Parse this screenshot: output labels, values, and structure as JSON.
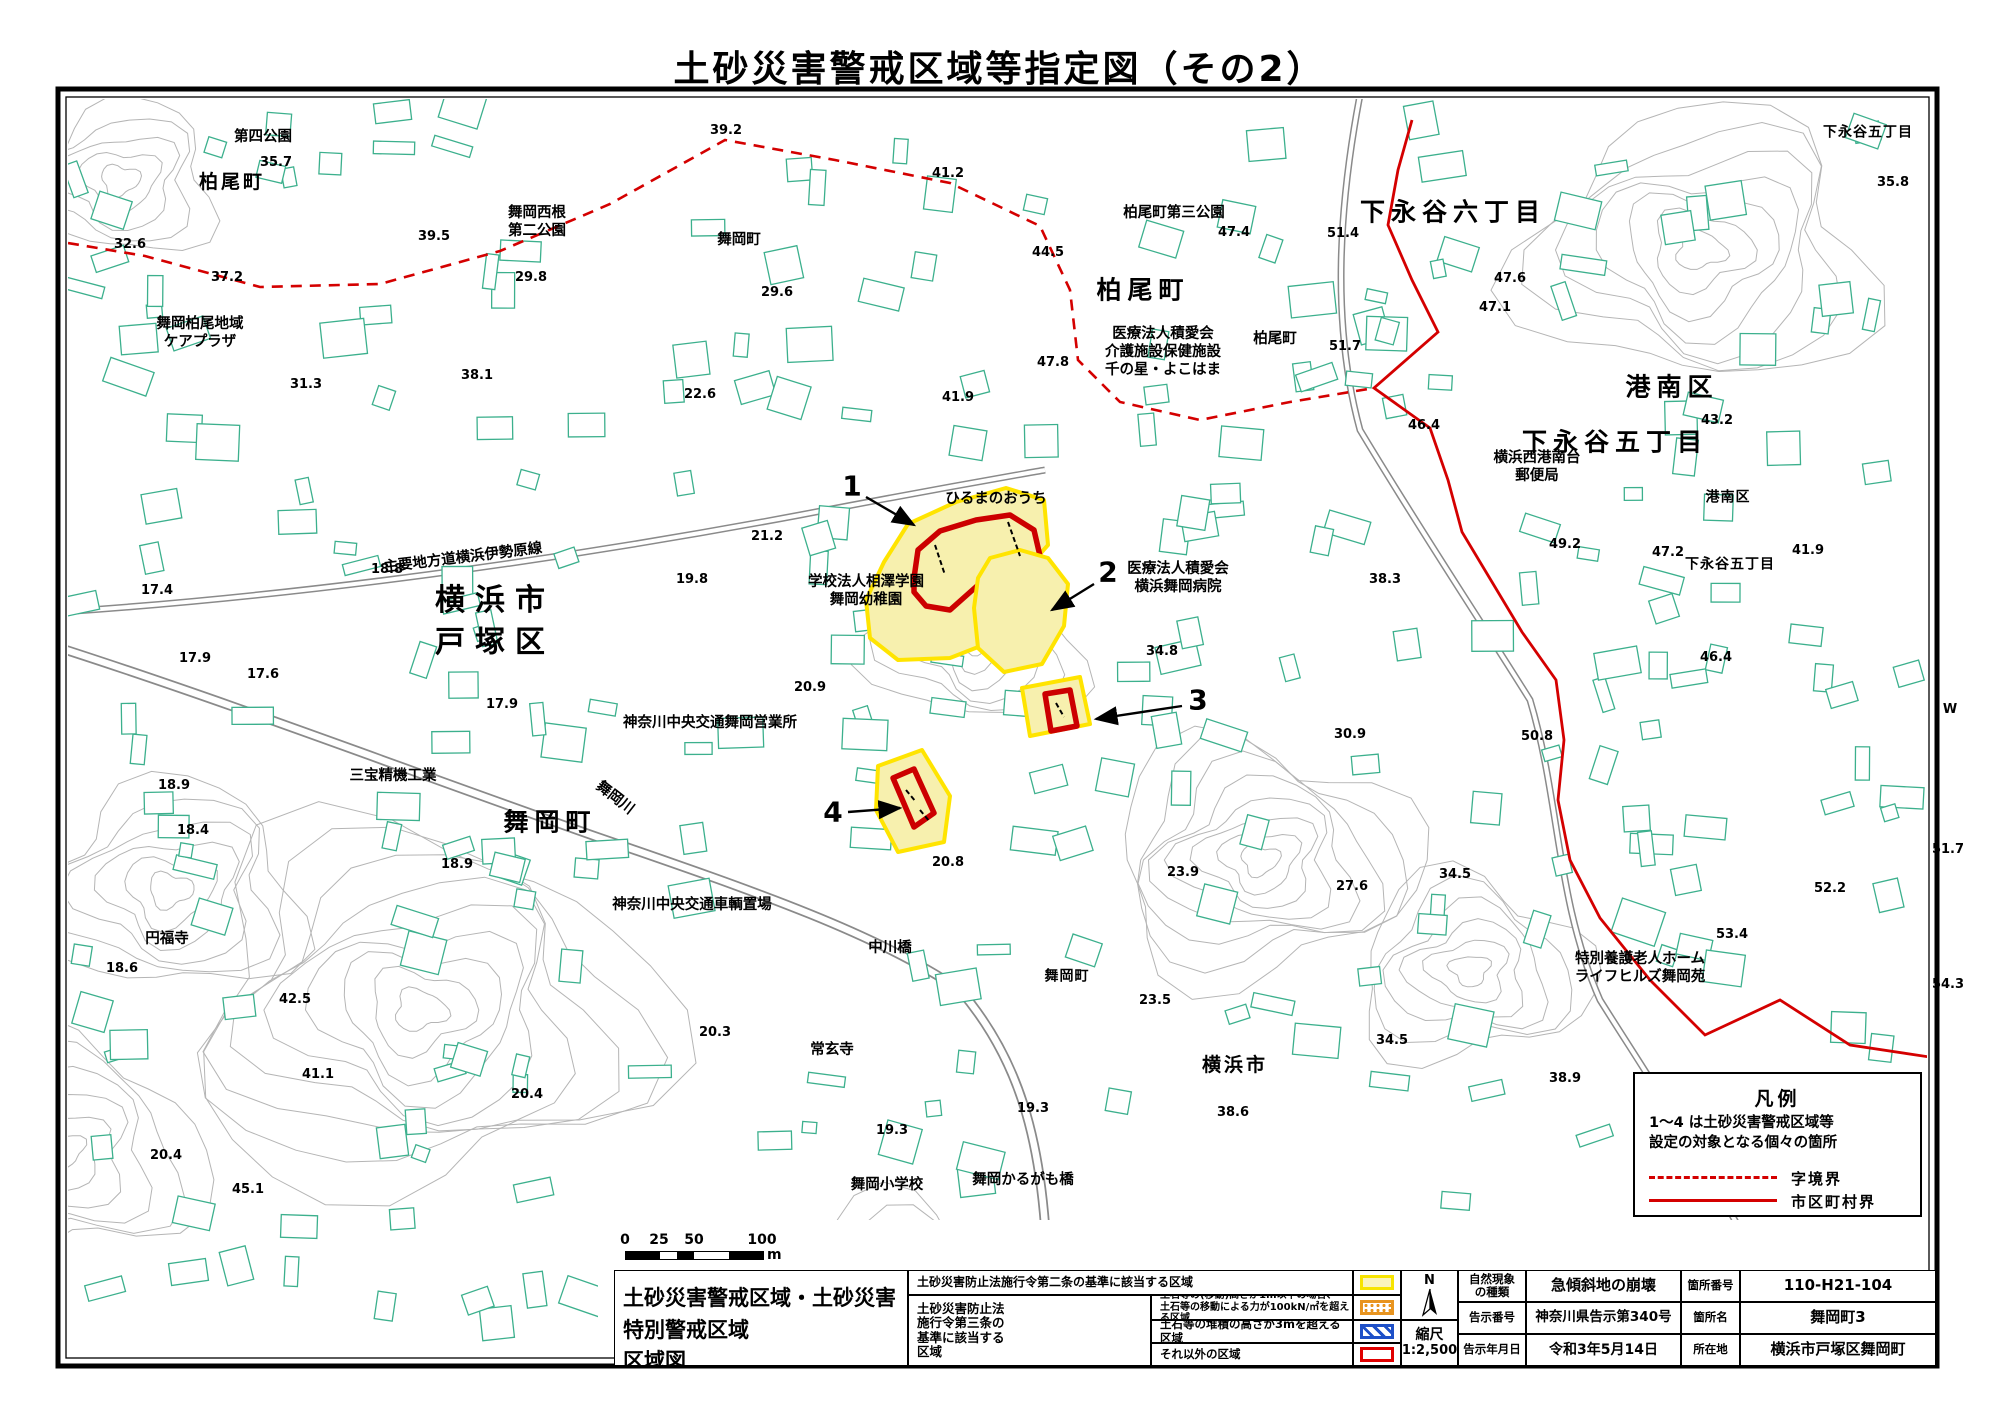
{
  "page_title": "土砂災害警戒区域等指定図（その2）",
  "legend_box": {
    "title": "凡例",
    "note_line1": "1〜4 は土砂災害警戒区域等",
    "note_line2": "設定の対象となる個々の箇所",
    "dashed_label": "字境界",
    "solid_label": "市区町村界",
    "line_color": "#d40000"
  },
  "scale_bar": {
    "ticks": [
      "0",
      "25",
      "50",
      "100"
    ],
    "unit": "m"
  },
  "info_table": {
    "map_title_line1": "土砂災害警戒区域・土砂災害特別警戒区域",
    "map_title_line2": "区域図",
    "law2_label": "土砂災害防止法施行令第二条の基準に該当する区域",
    "law3_group_label": "土砂災害防止法\n施行令第三条の\n基準に該当する\n区域",
    "law3_row1": "土石等の(移動)高さが1m以下の場合、\n土石等の移動による力が100kN/㎡を超える区域",
    "law3_row2": "土石等の堆積の高さが3mを超える区域",
    "law3_row3": "それ以外の区域",
    "north_label": "N",
    "scale_label": "縮尺",
    "scale_value": "1:2,500",
    "nature_label": "自然現象\nの種類",
    "nature_value": "急傾斜地の崩壊",
    "notice_no_label": "告示番号",
    "notice_no_value": "神奈川県告示第340号",
    "notice_date_label": "告示年月日",
    "notice_date_value": "令和3年5月14日",
    "site_no_label": "箇所番号",
    "site_no_value": "110-H21-104",
    "site_name_label": "箇所名",
    "site_name_value": "舞岡町3",
    "location_label": "所在地",
    "location_value": "横浜市戸塚区舞岡町",
    "swatch_colors": {
      "yellow_border": "#f7e400",
      "yellow_fill": "#faf4bc",
      "orange": "#e8941f",
      "blue": "#1e50c8",
      "red": "#e00000"
    }
  },
  "map": {
    "colors": {
      "building": "#3cb08d",
      "contour": "#b5b5b5",
      "road": "#8a8a8a",
      "boundary": "#d40000",
      "zone_fill": "#f7f0ae",
      "zone_border": "#ffe400",
      "zone_red": "#cc0000"
    },
    "boundary_dashed": [
      [
        68,
        243
      ],
      [
        145,
        256
      ],
      [
        260,
        287
      ],
      [
        380,
        284
      ],
      [
        500,
        251
      ],
      [
        610,
        204
      ],
      [
        725,
        140
      ],
      [
        835,
        160
      ],
      [
        950,
        183
      ],
      [
        1040,
        226
      ],
      [
        1070,
        290
      ],
      [
        1078,
        360
      ],
      [
        1120,
        402
      ],
      [
        1200,
        420
      ],
      [
        1290,
        402
      ],
      [
        1374,
        388
      ]
    ],
    "boundary_solid": [
      [
        1412,
        120
      ],
      [
        1398,
        170
      ],
      [
        1388,
        225
      ],
      [
        1412,
        280
      ],
      [
        1438,
        332
      ],
      [
        1374,
        388
      ],
      [
        1430,
        428
      ],
      [
        1448,
        480
      ],
      [
        1462,
        532
      ],
      [
        1492,
        582
      ],
      [
        1522,
        632
      ],
      [
        1556,
        680
      ],
      [
        1564,
        740
      ],
      [
        1558,
        800
      ],
      [
        1570,
        860
      ],
      [
        1600,
        918
      ],
      [
        1650,
        980
      ],
      [
        1705,
        1035
      ],
      [
        1780,
        1000
      ],
      [
        1850,
        1045
      ],
      [
        1936,
        1058
      ]
    ],
    "zones": [
      {
        "id": "1",
        "yellow": [
          [
            884,
            562
          ],
          [
            908,
            524
          ],
          [
            956,
            502
          ],
          [
            1006,
            488
          ],
          [
            1044,
            500
          ],
          [
            1048,
            545
          ],
          [
            1024,
            572
          ],
          [
            1024,
            610
          ],
          [
            996,
            640
          ],
          [
            950,
            658
          ],
          [
            898,
            660
          ],
          [
            870,
            638
          ],
          [
            866,
            600
          ]
        ],
        "red": [
          [
            914,
            578
          ],
          [
            918,
            550
          ],
          [
            940,
            531
          ],
          [
            976,
            520
          ],
          [
            1010,
            515
          ],
          [
            1034,
            530
          ],
          [
            1040,
            556
          ],
          [
            1012,
            570
          ],
          [
            986,
            578
          ],
          [
            968,
            594
          ],
          [
            950,
            610
          ],
          [
            926,
            606
          ],
          [
            914,
            592
          ]
        ]
      },
      {
        "id": "2",
        "yellow": [
          [
            990,
            558
          ],
          [
            1020,
            550
          ],
          [
            1048,
            558
          ],
          [
            1068,
            584
          ],
          [
            1064,
            626
          ],
          [
            1042,
            664
          ],
          [
            1004,
            672
          ],
          [
            978,
            648
          ],
          [
            974,
            608
          ],
          [
            978,
            578
          ]
        ],
        "red": []
      },
      {
        "id": "3",
        "yellow": [
          [
            1022,
            688
          ],
          [
            1080,
            677
          ],
          [
            1090,
            724
          ],
          [
            1030,
            736
          ]
        ],
        "red": [
          [
            1045,
            694
          ],
          [
            1070,
            690
          ],
          [
            1077,
            726
          ],
          [
            1051,
            731
          ]
        ]
      },
      {
        "id": "4",
        "yellow": [
          [
            878,
            766
          ],
          [
            922,
            750
          ],
          [
            950,
            796
          ],
          [
            944,
            842
          ],
          [
            898,
            852
          ],
          [
            876,
            810
          ]
        ],
        "red": [
          [
            893,
            778
          ],
          [
            914,
            769
          ],
          [
            934,
            813
          ],
          [
            914,
            827
          ]
        ]
      }
    ],
    "zone_markers": [
      {
        "label": "1",
        "lx": 852,
        "ly": 486,
        "ax": 866,
        "ay": 497,
        "bx": 914,
        "by": 525
      },
      {
        "label": "2",
        "lx": 1108,
        "ly": 572,
        "ax": 1094,
        "ay": 584,
        "bx": 1052,
        "by": 610
      },
      {
        "label": "3",
        "lx": 1198,
        "ly": 700,
        "ax": 1182,
        "ay": 706,
        "bx": 1096,
        "by": 719
      },
      {
        "label": "4",
        "lx": 833,
        "ly": 812,
        "ax": 848,
        "ay": 812,
        "bx": 900,
        "by": 808
      }
    ],
    "labels": [
      {
        "t": "第四公園",
        "x": 263,
        "y": 137,
        "c": "fac"
      },
      {
        "t": "柏尾町",
        "x": 232,
        "y": 183,
        "c": "area-md"
      },
      {
        "t": "舞岡西根\n第二公園",
        "x": 537,
        "y": 222,
        "c": "fac"
      },
      {
        "t": "舞岡町",
        "x": 739,
        "y": 240,
        "c": "fac"
      },
      {
        "t": "舞岡柏尾地域\nケアプラザ",
        "x": 200,
        "y": 333,
        "c": "fac"
      },
      {
        "t": "柏尾町第三公園",
        "x": 1174,
        "y": 213,
        "c": "fac"
      },
      {
        "t": "柏尾町",
        "x": 1143,
        "y": 290,
        "c": "area-lg"
      },
      {
        "t": "医療法人積愛会\n介護施設保健施設\n千の星・よこはま",
        "x": 1163,
        "y": 352,
        "c": "fac"
      },
      {
        "t": "柏尾町",
        "x": 1275,
        "y": 339,
        "c": "fac"
      },
      {
        "t": "下永谷六丁目",
        "x": 1453,
        "y": 212,
        "c": "area-lg"
      },
      {
        "t": "下永谷五丁目",
        "x": 1868,
        "y": 133,
        "c": "area-sm"
      },
      {
        "t": "港南区",
        "x": 1672,
        "y": 387,
        "c": "area-lg"
      },
      {
        "t": "下永谷五丁目",
        "x": 1615,
        "y": 442,
        "c": "area-lg"
      },
      {
        "t": "横浜西港南台\n郵便局",
        "x": 1537,
        "y": 467,
        "c": "fac"
      },
      {
        "t": "港南区",
        "x": 1728,
        "y": 498,
        "c": "area-sm"
      },
      {
        "t": "下永谷五丁目",
        "x": 1730,
        "y": 565,
        "c": "area-sm"
      },
      {
        "t": "ひるまのおうち",
        "x": 996,
        "y": 499,
        "c": "fac"
      },
      {
        "t": "学校法人相澤学園\n舞岡幼稚園",
        "x": 866,
        "y": 591,
        "c": "fac"
      },
      {
        "t": "医療法人積愛会\n横浜舞岡病院",
        "x": 1178,
        "y": 578,
        "c": "fac"
      },
      {
        "t": "横浜市\n戸塚区",
        "x": 495,
        "y": 622,
        "c": "area-xl"
      },
      {
        "t": "主要地方道横浜伊勢原線",
        "x": 463,
        "y": 558,
        "c": "fac",
        "r": -7
      },
      {
        "t": "神奈川中央交通舞岡営業所",
        "x": 710,
        "y": 723,
        "c": "fac"
      },
      {
        "t": "三宝精機工業",
        "x": 393,
        "y": 776,
        "c": "fac"
      },
      {
        "t": "舞岡川",
        "x": 615,
        "y": 798,
        "c": "fac",
        "r": 38
      },
      {
        "t": "舞岡町",
        "x": 550,
        "y": 822,
        "c": "area-lg"
      },
      {
        "t": "神奈川中央交通車輌置場",
        "x": 692,
        "y": 905,
        "c": "fac"
      },
      {
        "t": "円福寺",
        "x": 167,
        "y": 939,
        "c": "fac"
      },
      {
        "t": "中川橋",
        "x": 890,
        "y": 948,
        "c": "fac"
      },
      {
        "t": "舞岡町",
        "x": 1067,
        "y": 977,
        "c": "area-sm"
      },
      {
        "t": "特別養護老人ホーム\nライフヒルズ舞岡苑",
        "x": 1640,
        "y": 968,
        "c": "fac"
      },
      {
        "t": "常玄寺",
        "x": 832,
        "y": 1050,
        "c": "fac"
      },
      {
        "t": "横浜市",
        "x": 1235,
        "y": 1066,
        "c": "area-md"
      },
      {
        "t": "舞岡小学校",
        "x": 887,
        "y": 1185,
        "c": "fac"
      },
      {
        "t": "舞岡かるがも橋",
        "x": 1023,
        "y": 1180,
        "c": "fac"
      }
    ],
    "elevations": [
      {
        "v": "39.2",
        "x": 726,
        "y": 131
      },
      {
        "v": "35.7",
        "x": 276,
        "y": 163
      },
      {
        "v": "41.2",
        "x": 948,
        "y": 174
      },
      {
        "v": "32.6",
        "x": 130,
        "y": 245
      },
      {
        "v": "39.5",
        "x": 434,
        "y": 237
      },
      {
        "v": "37.2",
        "x": 227,
        "y": 278
      },
      {
        "v": "29.8",
        "x": 531,
        "y": 278
      },
      {
        "v": "29.6",
        "x": 777,
        "y": 293
      },
      {
        "v": "44.5",
        "x": 1048,
        "y": 253
      },
      {
        "v": "47.4",
        "x": 1234,
        "y": 233
      },
      {
        "v": "51.4",
        "x": 1343,
        "y": 234
      },
      {
        "v": "47.6",
        "x": 1510,
        "y": 279
      },
      {
        "v": "47.1",
        "x": 1495,
        "y": 308
      },
      {
        "v": "35.8",
        "x": 1893,
        "y": 183
      },
      {
        "v": "31.3",
        "x": 306,
        "y": 385
      },
      {
        "v": "38.1",
        "x": 477,
        "y": 376
      },
      {
        "v": "22.6",
        "x": 700,
        "y": 395
      },
      {
        "v": "51.7",
        "x": 1345,
        "y": 347
      },
      {
        "v": "47.8",
        "x": 1053,
        "y": 363
      },
      {
        "v": "41.9",
        "x": 958,
        "y": 398
      },
      {
        "v": "46.4",
        "x": 1424,
        "y": 426
      },
      {
        "v": "21.2",
        "x": 767,
        "y": 537
      },
      {
        "v": "19.8",
        "x": 692,
        "y": 580
      },
      {
        "v": "18.8",
        "x": 387,
        "y": 570
      },
      {
        "v": "17.4",
        "x": 157,
        "y": 591
      },
      {
        "v": "38.3",
        "x": 1385,
        "y": 580
      },
      {
        "v": "49.2",
        "x": 1565,
        "y": 545
      },
      {
        "v": "43.2",
        "x": 1717,
        "y": 421
      },
      {
        "v": "41.9",
        "x": 1808,
        "y": 551
      },
      {
        "v": "47.2",
        "x": 1668,
        "y": 553
      },
      {
        "v": "46.4",
        "x": 1716,
        "y": 658
      },
      {
        "v": "34.8",
        "x": 1162,
        "y": 652
      },
      {
        "v": "17.9",
        "x": 195,
        "y": 659
      },
      {
        "v": "17.6",
        "x": 263,
        "y": 675
      },
      {
        "v": "17.9",
        "x": 502,
        "y": 705
      },
      {
        "v": "20.9",
        "x": 810,
        "y": 688
      },
      {
        "v": "30.9",
        "x": 1350,
        "y": 735
      },
      {
        "v": "50.8",
        "x": 1537,
        "y": 737
      },
      {
        "v": "W",
        "x": 1950,
        "y": 710
      },
      {
        "v": "18.9",
        "x": 174,
        "y": 786
      },
      {
        "v": "18.4",
        "x": 193,
        "y": 831
      },
      {
        "v": "18.9",
        "x": 457,
        "y": 865
      },
      {
        "v": "20.8",
        "x": 948,
        "y": 863
      },
      {
        "v": "23.9",
        "x": 1183,
        "y": 873
      },
      {
        "v": "27.6",
        "x": 1352,
        "y": 887
      },
      {
        "v": "34.5",
        "x": 1455,
        "y": 875
      },
      {
        "v": "34.5",
        "x": 1392,
        "y": 1041
      },
      {
        "v": "51.7",
        "x": 1948,
        "y": 850
      },
      {
        "v": "52.2",
        "x": 1830,
        "y": 889
      },
      {
        "v": "53.4",
        "x": 1732,
        "y": 935
      },
      {
        "v": "54.3",
        "x": 1948,
        "y": 985
      },
      {
        "v": "18.6",
        "x": 122,
        "y": 969
      },
      {
        "v": "42.5",
        "x": 295,
        "y": 1000
      },
      {
        "v": "41.1",
        "x": 318,
        "y": 1075
      },
      {
        "v": "20.4",
        "x": 527,
        "y": 1095
      },
      {
        "v": "20.4",
        "x": 166,
        "y": 1156
      },
      {
        "v": "45.1",
        "x": 248,
        "y": 1190
      },
      {
        "v": "23.5",
        "x": 1155,
        "y": 1001
      },
      {
        "v": "20.3",
        "x": 715,
        "y": 1033
      },
      {
        "v": "19.3",
        "x": 892,
        "y": 1131
      },
      {
        "v": "19.3",
        "x": 1033,
        "y": 1109
      },
      {
        "v": "38.6",
        "x": 1233,
        "y": 1113
      },
      {
        "v": "38.9",
        "x": 1565,
        "y": 1079
      }
    ]
  }
}
